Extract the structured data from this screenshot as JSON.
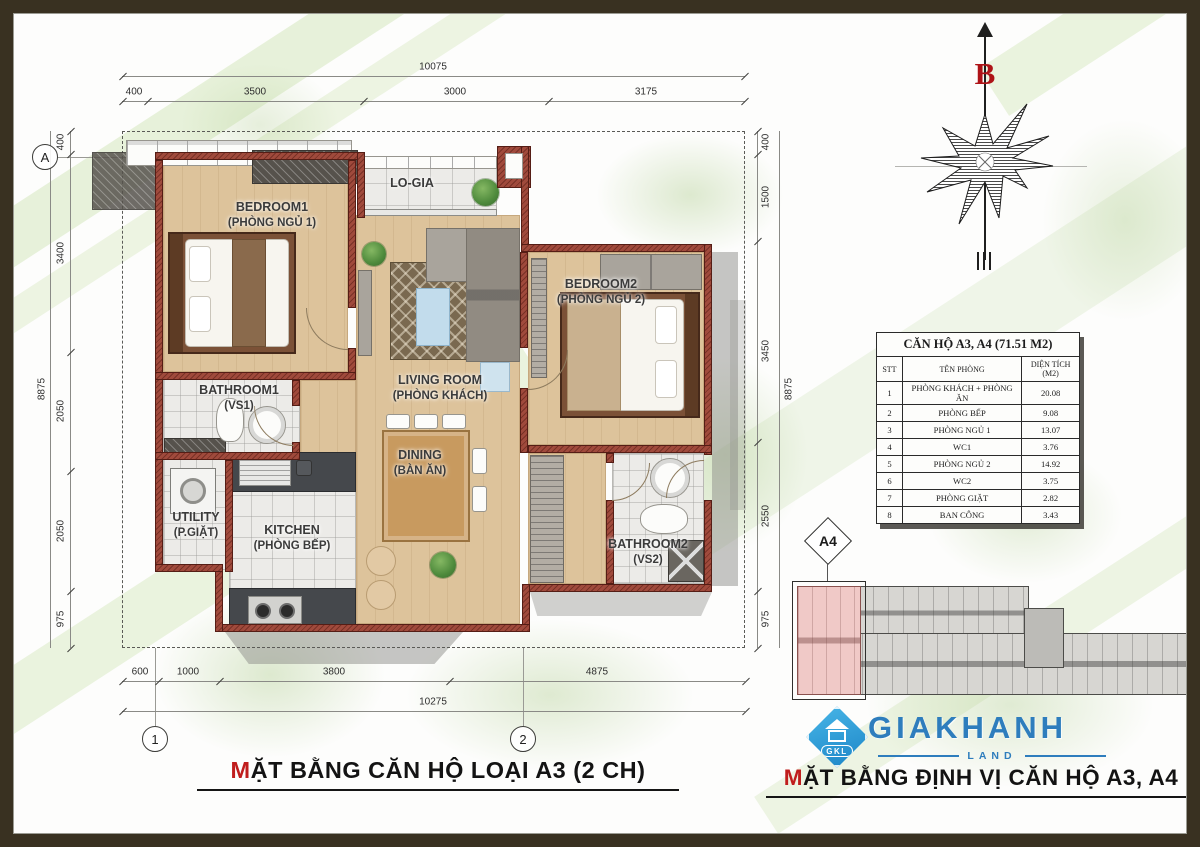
{
  "plan": {
    "rooms": {
      "bedroom1": {
        "name": "BEDROOM1",
        "sub": "(PHÒNG NGỦ 1)"
      },
      "logia": {
        "name": "LO-GIA",
        "sub": ""
      },
      "living": {
        "name": "LIVING ROOM",
        "sub": "(PHÒNG KHÁCH)"
      },
      "bedroom2": {
        "name": "BEDROOM2",
        "sub": "(PHÒNG NGỦ 2)"
      },
      "bathroom1": {
        "name": "BATHROOM1",
        "sub": "(VS1)"
      },
      "dining": {
        "name": "DINING",
        "sub": "(BÀN ĂN)"
      },
      "utility": {
        "name": "UTILITY",
        "sub": "(P.GIẶT)"
      },
      "kitchen": {
        "name": "KITCHEN",
        "sub": "(PHÒNG BẾP)"
      },
      "bathroom2": {
        "name": "BATHROOM2",
        "sub": "(VS2)"
      }
    },
    "grid_markers": {
      "row": "A",
      "col1": "1",
      "col2": "2"
    },
    "dims": {
      "top_total": "10075",
      "top": [
        "400",
        "3500",
        "3000",
        "3175"
      ],
      "left_total": "8875",
      "left": [
        "400",
        "3400",
        "2050",
        "2050",
        "975"
      ],
      "right_total": "8875",
      "right": [
        "400",
        "1500",
        "3450",
        "2550",
        "975"
      ],
      "bottom": [
        "600",
        "1000",
        "3800",
        "4875"
      ],
      "bottom_total": "10275"
    }
  },
  "compass": {
    "direction_label": "B"
  },
  "table": {
    "title": "CĂN HỘ A3, A4 (71.51 M2)",
    "headers": [
      "STT",
      "TÊN PHÒNG",
      "DIỆN TÍCH (M2)"
    ],
    "rows": [
      [
        "1",
        "PHÒNG KHÁCH + PHÒNG ĂN",
        "20.08"
      ],
      [
        "2",
        "PHÒNG BẾP",
        "9.08"
      ],
      [
        "3",
        "PHÒNG NGỦ 1",
        "13.07"
      ],
      [
        "4",
        "WC1",
        "3.76"
      ],
      [
        "5",
        "PHÒNG NGỦ 2",
        "14.92"
      ],
      [
        "6",
        "WC2",
        "3.75"
      ],
      [
        "7",
        "PHÒNG GIẶT",
        "2.82"
      ],
      [
        "8",
        "BAN CÔNG",
        "3.43"
      ]
    ]
  },
  "keyplan": {
    "unit_label": "A4"
  },
  "logo": {
    "brand": "GIAKHANH",
    "subtitle": "LAND",
    "monogram": "GKL"
  },
  "titles": {
    "left": {
      "accent": "M",
      "rest": "ẶT BẰNG CĂN HỘ LOẠI A3 (2 CH)"
    },
    "right": {
      "accent": "M",
      "rest": "ẶT BẰNG ĐỊNH VỊ CĂN HỘ A3, A4"
    }
  },
  "colors": {
    "accent_red": "#c01d1d",
    "brand_blue": "#2e7dbd",
    "wall_brick": "#a04a3c",
    "highlight_pink": "#f0c9c7"
  }
}
